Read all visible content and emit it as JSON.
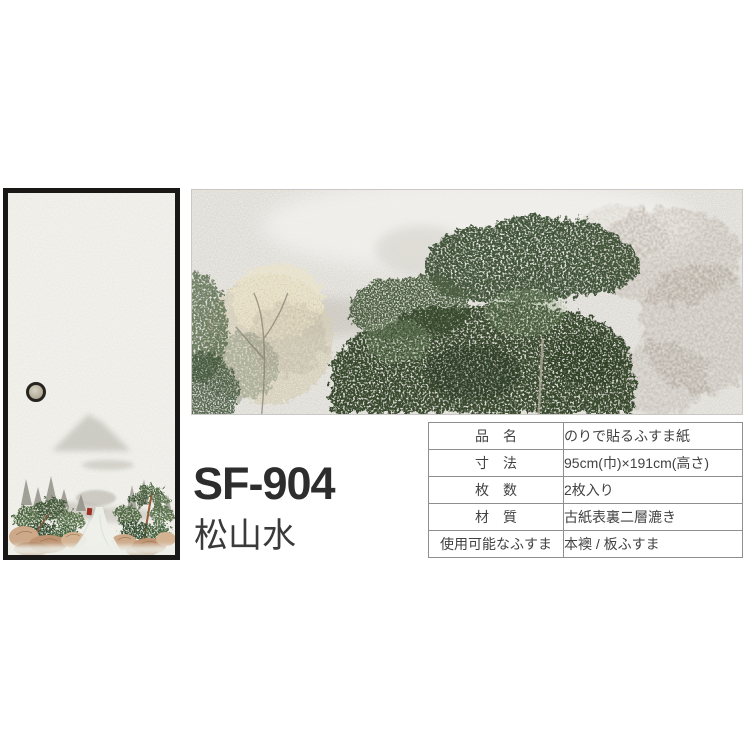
{
  "product": {
    "code": "SF-904",
    "name": "松山水"
  },
  "spec_table": {
    "rows": [
      {
        "label": "品　名",
        "value": "のりで貼るふすま紙"
      },
      {
        "label": "寸　法",
        "value": "95cm(巾)×191cm(高さ)"
      },
      {
        "label": "枚　数",
        "value": "2枚入り"
      },
      {
        "label": "材　質",
        "value": "古紙表裏二層漉き"
      },
      {
        "label": "使用可能なふすま",
        "value": "本襖 / 板ふすま"
      }
    ]
  },
  "images": {
    "door_preview": "fusuma-door-with-pine-landscape-painting",
    "texture_detail": "washi-paper-tree-painting-closeup",
    "door_pull_icon": "round-door-pull"
  },
  "colors": {
    "background": "#ffffff",
    "door_frame": "#1a1816",
    "door_paper": "#f3f2ed",
    "detail_paper": "#eae8e3",
    "pine_green": "#44603a",
    "foliage_dark": "#37482f",
    "blossom_cream": "#ebe4c9",
    "ink_gray": "#a39588",
    "rock_tan": "#cda98a",
    "red_accent": "#9e2f22",
    "text_dark": "#2d2d2d",
    "table_border": "#8e8e8e",
    "table_text": "#424242"
  }
}
